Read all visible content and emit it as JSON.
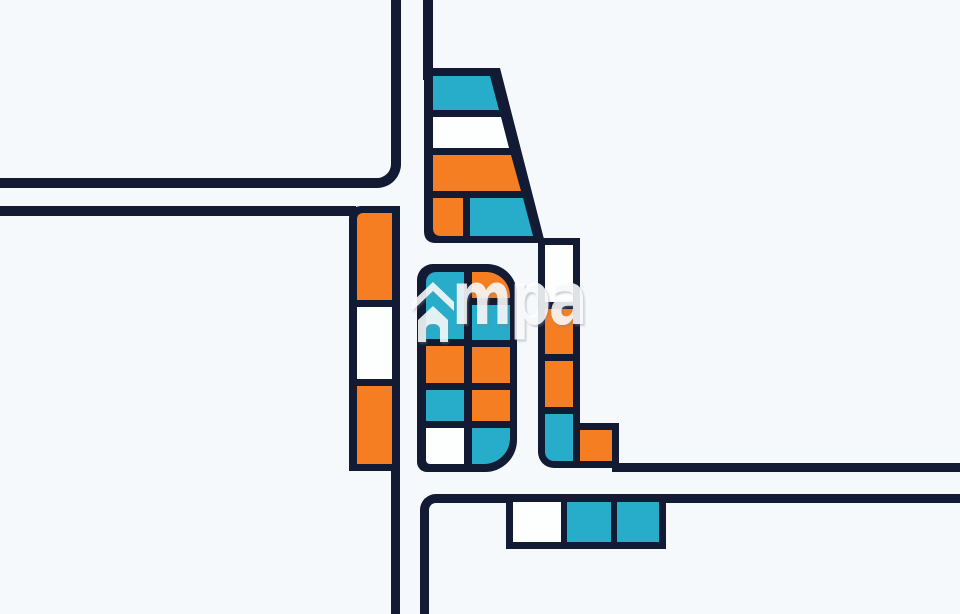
{
  "watermark": {
    "text": "mpa",
    "icon": "house-chevron"
  },
  "palette": {
    "navy": "#131a33",
    "orange": "#f57e22",
    "cyan": "#27adc9",
    "white": "#fdfefe",
    "background": "#f5f9fb",
    "watermark_white": "rgba(255,255,255,0.85)"
  },
  "parcels": {
    "top_trapezoid": {
      "rows": [
        "cyan",
        "white",
        "orange"
      ],
      "bottom_row": [
        "orange",
        "cyan"
      ]
    },
    "left_strip": {
      "cells": [
        "orange",
        "white",
        "orange"
      ]
    },
    "center_block": {
      "left_col": [
        "cyan",
        "orange",
        "cyan",
        "white"
      ],
      "right_col": [
        "orange",
        "cyan",
        "orange",
        "orange",
        "cyan"
      ]
    },
    "right_strip": {
      "cells": [
        "white",
        "orange",
        "orange",
        "cyan"
      ],
      "foot": "orange"
    },
    "bottom_row": {
      "cells": [
        "white",
        "cyan",
        "cyan"
      ]
    }
  }
}
